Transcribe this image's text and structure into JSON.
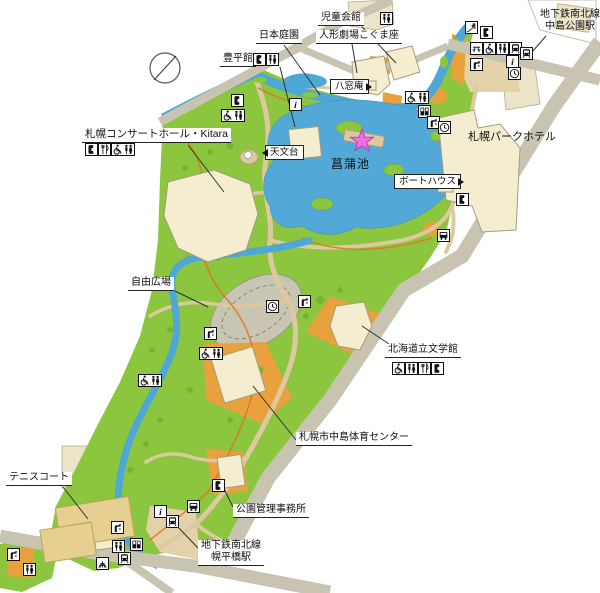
{
  "map_name": "nakajima-park-guide-map",
  "colors": {
    "park_green": "#8cc63f",
    "pond_blue": "#52a9d8",
    "river_blue": "#4fa7d6",
    "road_gray": "#c9c4b2",
    "path_tan": "#dcc9a0",
    "plaza_tan": "#e3d2a9",
    "playground_orange": "#e8a13c",
    "building_cream": "#f5edd0",
    "tennis_court_tan": "#e6cf90",
    "field_gray": "#c9c5b3",
    "jogging_course_orange": "#e0761f",
    "star_pink": "#f26ee8"
  },
  "marker": {
    "name": "current-location-star",
    "color": "#f26ee8"
  },
  "labels": [
    {
      "id": "label-jido-kaikan",
      "text": "児童会館",
      "x": 318,
      "y": 12,
      "style": "underline"
    },
    {
      "id": "label-nakajima-koen-station",
      "lines": [
        "地下鉄南北線",
        "中島公園駅"
      ],
      "x": 540,
      "y": 9,
      "style": "plain"
    },
    {
      "id": "label-nihon-teien",
      "text": "日本庭園",
      "x": 256,
      "y": 30,
      "style": "underline"
    },
    {
      "id": "label-ningyo-gekijo-kogumaza",
      "text": "人形劇場こぐま座",
      "x": 316,
      "y": 30,
      "style": "underline"
    },
    {
      "id": "label-hoheikan",
      "text": "豊平館",
      "x": 220,
      "y": 53,
      "style": "underline"
    },
    {
      "id": "label-hassoan",
      "text": "八窓庵",
      "x": 330,
      "y": 79,
      "style": "box",
      "arrow": "right"
    },
    {
      "id": "label-sapporo-concert-hall-kitara",
      "text": "札幌コンサートホール・Kitara",
      "x": 82,
      "y": 128,
      "style": "underline",
      "fs": 10.5
    },
    {
      "id": "label-tenmondai",
      "text": "天文台",
      "x": 265,
      "y": 145,
      "style": "box",
      "arrow": "left"
    },
    {
      "id": "label-shobu-ike",
      "text": "菖蒲池",
      "x": 331,
      "y": 157,
      "style": "plain",
      "fs": 12,
      "ls": 1
    },
    {
      "id": "label-boathouse",
      "text": "ボートハウス",
      "x": 394,
      "y": 174,
      "style": "box",
      "arrow": "right"
    },
    {
      "id": "label-sapporo-park-hotel",
      "text": "札幌パークホテル",
      "x": 468,
      "y": 131,
      "style": "plain",
      "fs": 11
    },
    {
      "id": "label-jiyu-hiroba",
      "text": "自由広場",
      "x": 128,
      "y": 277,
      "style": "underline"
    },
    {
      "id": "label-hokkaido-bungakukan",
      "text": "北海道立文学館",
      "x": 385,
      "y": 344,
      "style": "underline"
    },
    {
      "id": "label-nakajima-taiiku-center",
      "text": "札幌市中島体育センター",
      "x": 296,
      "y": 432,
      "style": "underline"
    },
    {
      "id": "label-tennis-court",
      "text": "テニスコート",
      "x": 6,
      "y": 472,
      "style": "underline"
    },
    {
      "id": "label-koen-kanri-jimusho",
      "text": "公園管理事務所",
      "x": 233,
      "y": 504,
      "style": "underline"
    },
    {
      "id": "label-horohirabashi-station",
      "lines": [
        "地下鉄南北線",
        "幌平橋駅"
      ],
      "x": 198,
      "y": 540,
      "style": "underline"
    }
  ],
  "leaders": [
    [
      362,
      27,
      396,
      63
    ],
    [
      546,
      36,
      532,
      52
    ],
    [
      284,
      45,
      320,
      95
    ],
    [
      352,
      44,
      357,
      73
    ],
    [
      280,
      67,
      295,
      127
    ],
    [
      188,
      145,
      224,
      192
    ],
    [
      175,
      291,
      208,
      307
    ],
    [
      389,
      344,
      362,
      326
    ],
    [
      296,
      440,
      253,
      386
    ],
    [
      63,
      487,
      88,
      519
    ],
    [
      233,
      507,
      219,
      479
    ],
    [
      198,
      548,
      177,
      526
    ]
  ],
  "icons": [
    {
      "glyphs": [
        "toilet"
      ],
      "x": 380,
      "y": 12
    },
    {
      "glyphs": [
        "phone"
      ],
      "x": 253,
      "y": 53
    },
    {
      "glyphs": [
        "toilet"
      ],
      "x": 266,
      "y": 53
    },
    {
      "glyphs": [
        "phone"
      ],
      "x": 85,
      "y": 143
    },
    {
      "glyphs": [
        "restaurant"
      ],
      "x": 98,
      "y": 143
    },
    {
      "glyphs": [
        "wheelchair",
        "toilet"
      ],
      "x": 111,
      "y": 143
    },
    {
      "glyphs": [
        "wheelchair"
      ],
      "x": 392,
      "y": 362
    },
    {
      "glyphs": [
        "toilet"
      ],
      "x": 405,
      "y": 362
    },
    {
      "glyphs": [
        "restaurant"
      ],
      "x": 418,
      "y": 362
    },
    {
      "glyphs": [
        "phone"
      ],
      "x": 431,
      "y": 362
    },
    {
      "glyphs": [
        "phone"
      ],
      "x": 231,
      "y": 94
    },
    {
      "glyphs": [
        "wheelchair",
        "toilet"
      ],
      "x": 221,
      "y": 109
    },
    {
      "glyphs": [
        "info"
      ],
      "x": 289,
      "y": 98
    },
    {
      "glyphs": [
        "wheelchair",
        "toilet"
      ],
      "x": 405,
      "y": 91
    },
    {
      "glyphs": [
        "vending"
      ],
      "x": 418,
      "y": 105
    },
    {
      "glyphs": [
        "fountain"
      ],
      "x": 427,
      "y": 116
    },
    {
      "glyphs": [
        "clock"
      ],
      "x": 438,
      "y": 121
    },
    {
      "glyphs": [
        "slide"
      ],
      "x": 465,
      "y": 21
    },
    {
      "glyphs": [
        "phone"
      ],
      "x": 480,
      "y": 26
    },
    {
      "glyphs": [
        "picnic"
      ],
      "x": 470,
      "y": 42
    },
    {
      "glyphs": [
        "wheelchair"
      ],
      "x": 483,
      "y": 42
    },
    {
      "glyphs": [
        "toilet"
      ],
      "x": 496,
      "y": 42
    },
    {
      "glyphs": [
        "subway"
      ],
      "x": 509,
      "y": 42
    },
    {
      "glyphs": [
        "fountain"
      ],
      "x": 470,
      "y": 58
    },
    {
      "glyphs": [
        "info"
      ],
      "x": 506,
      "y": 55
    },
    {
      "glyphs": [
        "subway"
      ],
      "x": 520,
      "y": 47
    },
    {
      "glyphs": [
        "clock"
      ],
      "x": 508,
      "y": 67
    },
    {
      "glyphs": [
        "phone"
      ],
      "x": 456,
      "y": 193
    },
    {
      "glyphs": [
        "bus"
      ],
      "x": 437,
      "y": 229
    },
    {
      "glyphs": [
        "clock"
      ],
      "x": 266,
      "y": 300
    },
    {
      "glyphs": [
        "fountain"
      ],
      "x": 298,
      "y": 295
    },
    {
      "glyphs": [
        "fountain"
      ],
      "x": 204,
      "y": 327
    },
    {
      "glyphs": [
        "wheelchair",
        "toilet"
      ],
      "x": 199,
      "y": 347
    },
    {
      "glyphs": [
        "wheelchair",
        "toilet"
      ],
      "x": 138,
      "y": 374
    },
    {
      "glyphs": [
        "phone"
      ],
      "x": 212,
      "y": 479
    },
    {
      "glyphs": [
        "bus"
      ],
      "x": 187,
      "y": 500
    },
    {
      "glyphs": [
        "info"
      ],
      "x": 154,
      "y": 505
    },
    {
      "glyphs": [
        "subway"
      ],
      "x": 166,
      "y": 515
    },
    {
      "glyphs": [
        "fountain"
      ],
      "x": 111,
      "y": 521
    },
    {
      "glyphs": [
        "toilet"
      ],
      "x": 112,
      "y": 540
    },
    {
      "glyphs": [
        "vending"
      ],
      "x": 130,
      "y": 538
    },
    {
      "glyphs": [
        "subway"
      ],
      "x": 118,
      "y": 552
    },
    {
      "glyphs": [
        "playground"
      ],
      "x": 96,
      "y": 557
    },
    {
      "glyphs": [
        "fountain"
      ],
      "x": 7,
      "y": 548
    },
    {
      "glyphs": [
        "toilet"
      ],
      "x": 23,
      "y": 563
    }
  ]
}
